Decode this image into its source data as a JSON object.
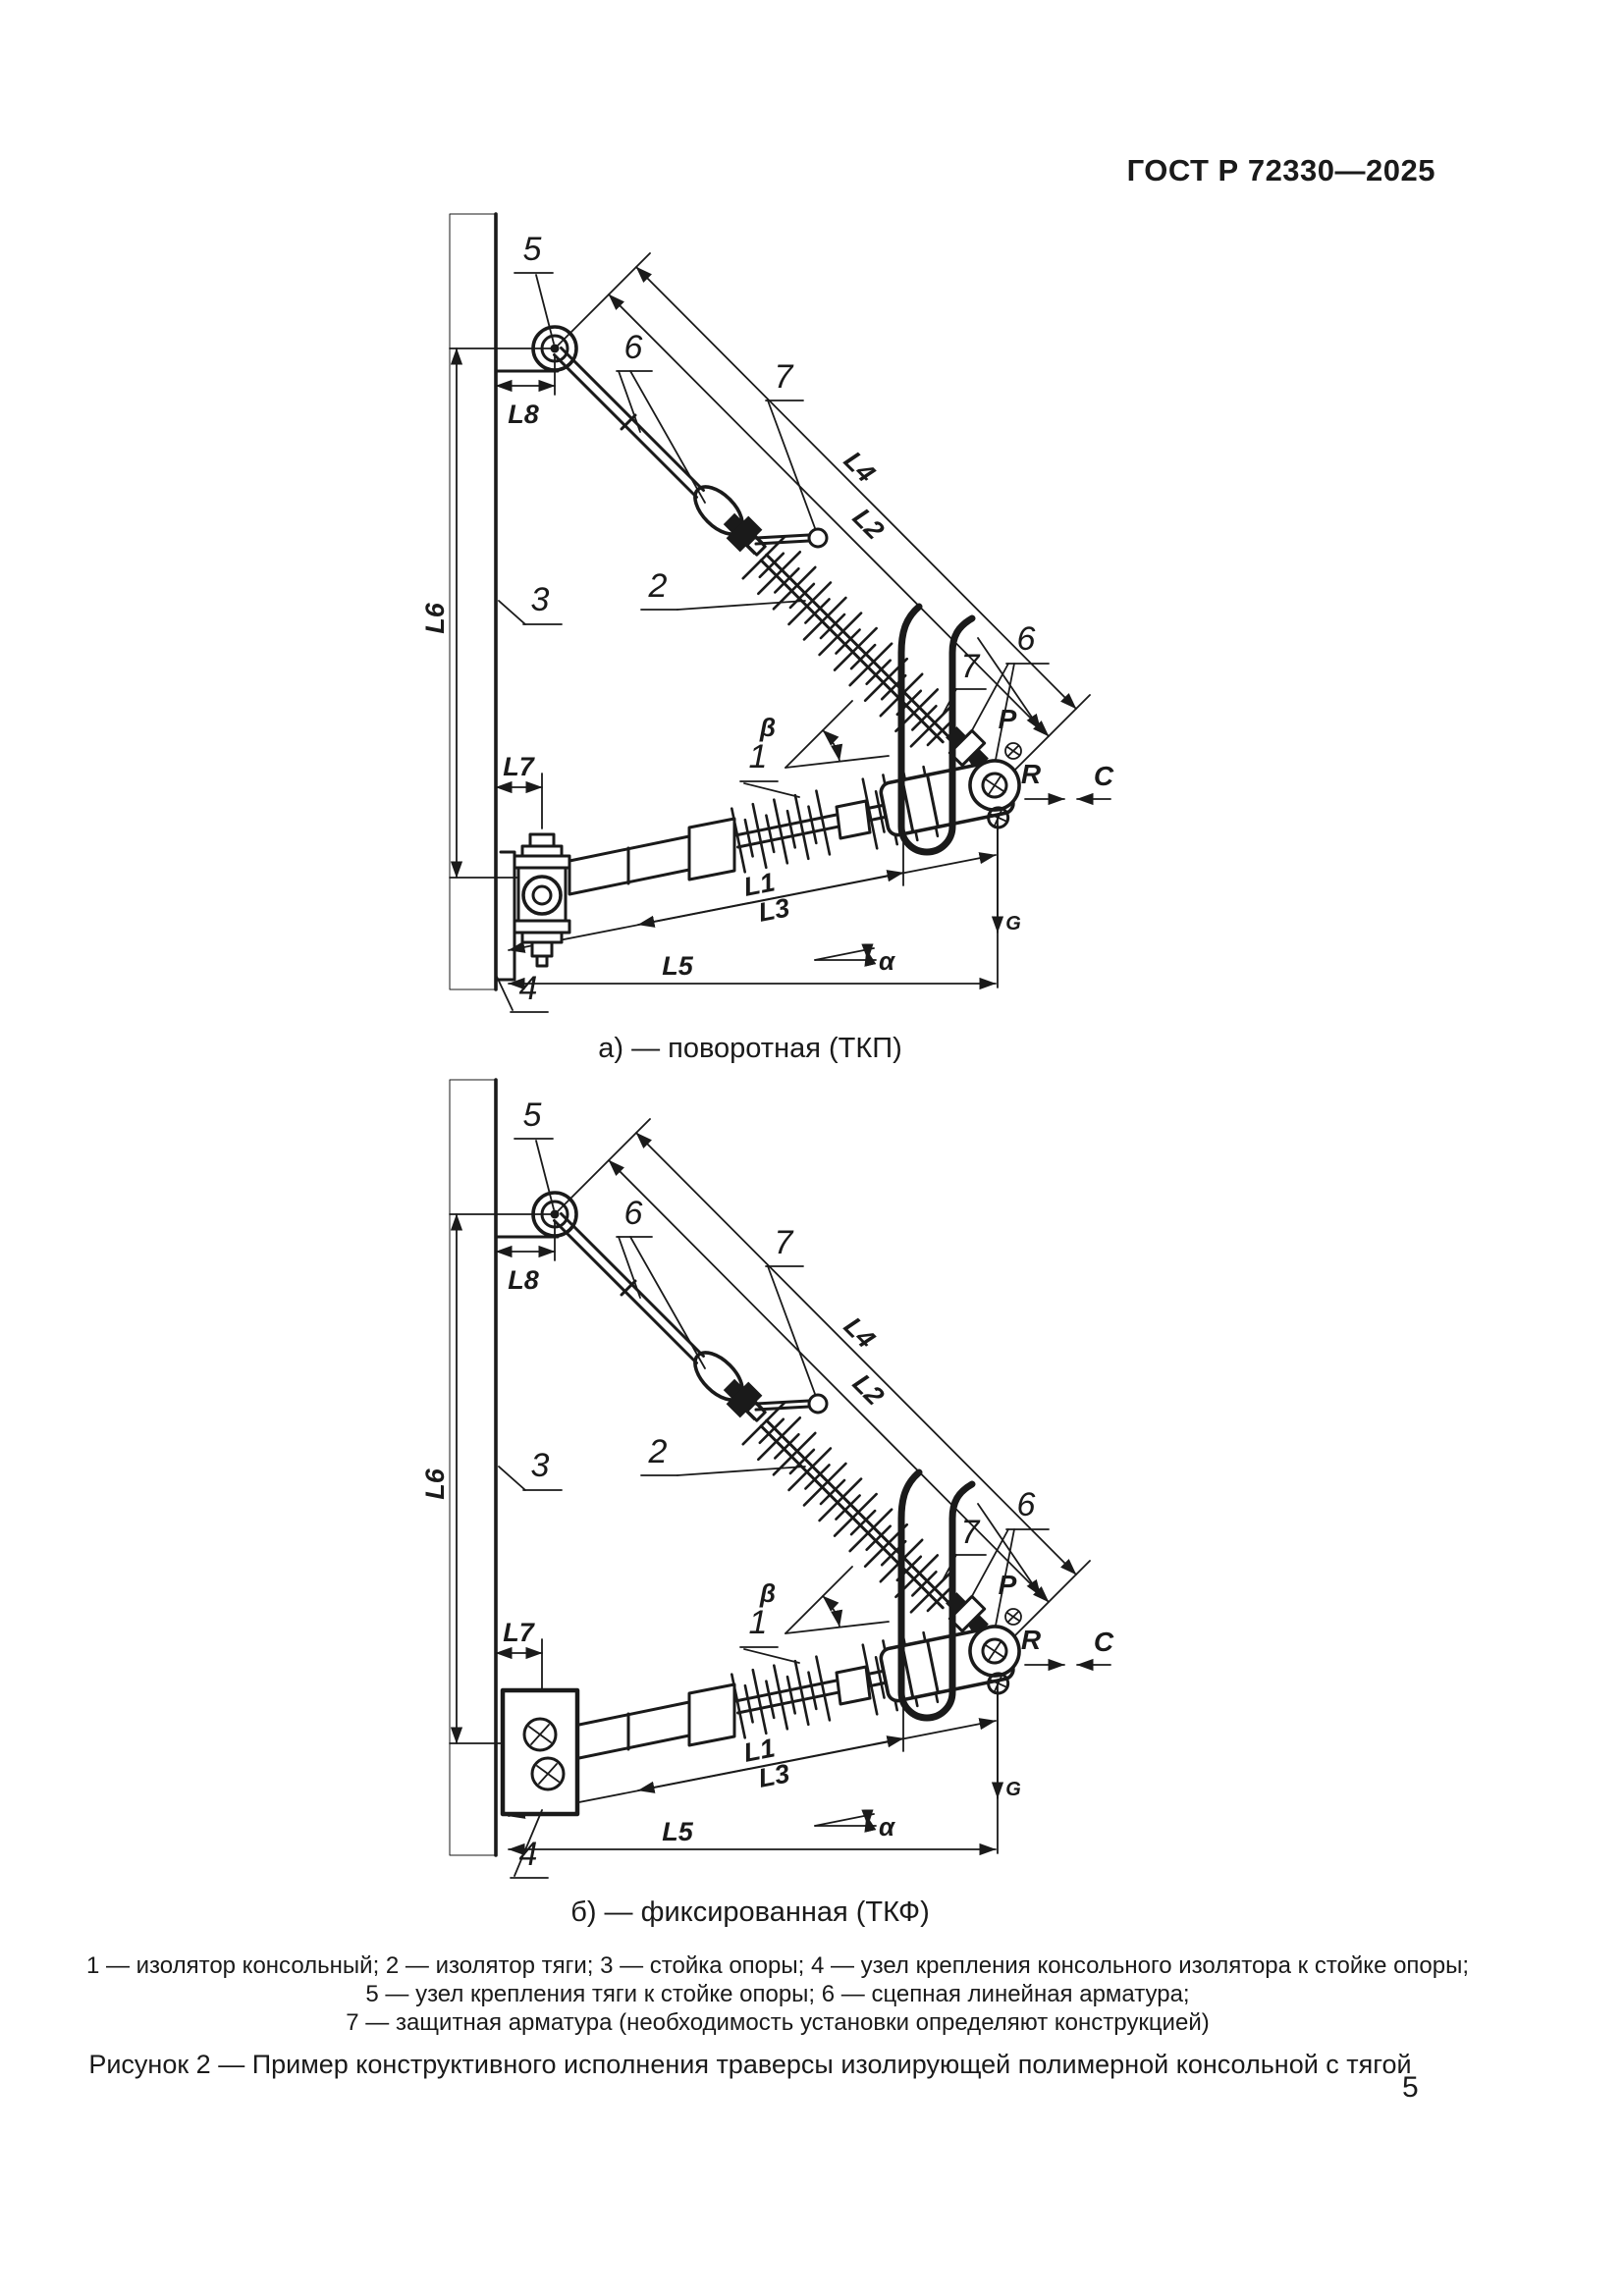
{
  "page": {
    "header": "ГОСТ Р 72330—2025",
    "page_number": "5"
  },
  "figure": {
    "caption_a": "а) — поворотная (ТКП)",
    "caption_b": "б) — фиксированная (ТКФ)",
    "legend_lines": [
      "1 — изолятор консольный; 2 — изолятор тяги; 3 — стойка опоры; 4 — узел крепления консольного изолятора к стойке опоры;",
      "5 — узел крепления тяги к стойке опоры; 6 — сцепная линейная арматура;",
      "7 — защитная арматура (необходимость установки определяют конструкцией)"
    ],
    "figure_caption": "Рисунок 2 — Пример конструктивного исполнения траверсы изолирующей полимерной консольной с тягой",
    "part_labels": {
      "n1": "1",
      "n2": "2",
      "n3": "3",
      "n4": "4",
      "n5": "5",
      "n6": "6",
      "n7": "7"
    },
    "dim_labels": {
      "L1": "L1",
      "L2": "L2",
      "L3": "L3",
      "L4": "L4",
      "L5": "L5",
      "L6": "L6",
      "L7": "L7",
      "L8": "L8"
    },
    "angle_labels": {
      "alpha": "α",
      "beta": "β"
    },
    "force_labels": {
      "P": "P",
      "R": "R",
      "C": "C",
      "G": "G"
    }
  }
}
